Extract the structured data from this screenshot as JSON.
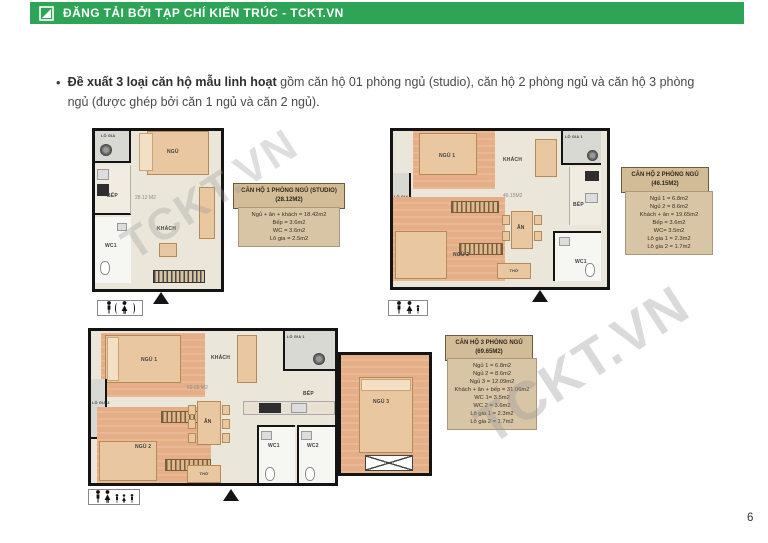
{
  "header": {
    "title": "ĐĂNG TẢI BỞI TẠP CHÍ KIẾN TRÚC - TCKT.VN",
    "logo_icon": "tckt-logo-icon",
    "bg_color": "#2EA457"
  },
  "intro": {
    "bullet": "•",
    "lead": "Đề xuất 3 loại căn hộ mẫu linh hoạt",
    "rest": " gồm căn hộ 01 phòng ngủ (studio), căn hộ 2 phòng ngủ và căn hộ 3 phòng ngủ (được ghép bởi căn 1 ngủ và căn 2 ngủ)."
  },
  "watermarks": [
    {
      "text": "TCKT.VN"
    },
    {
      "text": "TCKT.VN"
    }
  ],
  "plans": [
    {
      "id": "studio",
      "area_label": "28.12 M2",
      "rooms": {
        "logia": "LÔ GIA",
        "ngu": "NGỦ",
        "bep": "BẾP",
        "khach": "KHÁCH",
        "wc1": "WC1"
      },
      "entrance_icon": "up-triangle",
      "occupancy_icons": [
        "person-icon",
        "paren-person-icon"
      ]
    },
    {
      "id": "2-bedroom",
      "area_label": "46.15M2",
      "rooms": {
        "ngu1": "NGỦ 1",
        "khach": "KHÁCH",
        "logia1": "LÔ GIA 1",
        "logia2": "LÔ GIA 2",
        "ngu2": "NGỦ 2",
        "an": "ĂN",
        "bep": "BẾP",
        "tho": "THỜ",
        "wc1": "WC1"
      },
      "entrance_icon": "up-triangle",
      "occupancy_icons": [
        "person-icon",
        "person-icon",
        "child-icon"
      ]
    },
    {
      "id": "3-bedroom",
      "area_label": "69.65 M2",
      "rooms": {
        "ngu1": "NGỦ 1",
        "khach": "KHÁCH",
        "logia1": "LÔ GIA 1",
        "logia2": "LÔ GIA 2",
        "ngu2": "NGỦ 2",
        "ngu3": "NGỦ 3",
        "an": "ĂN",
        "bep": "BẾP",
        "tho": "THỜ",
        "wc1": "WC1",
        "wc2": "WC2"
      },
      "entrance_icon": "up-triangle",
      "occupancy_icons": [
        "person-icon",
        "person-icon",
        "child-icon",
        "child-icon",
        "child-icon"
      ]
    }
  ],
  "info_boxes": [
    {
      "title": "CĂN HỘ 1 PHÒNG NGỦ (STUDIO)",
      "subtitle": "(28.12M2)",
      "lines": [
        "Ngủ + ăn + khách = 18.42m2",
        "Bếp = 3.6m2",
        "WC = 3.6m2",
        "Lô gia = 2.5m2"
      ]
    },
    {
      "title": "CĂN HỘ 2 PHÒNG NGỦ",
      "subtitle": "(46.15M2)",
      "lines": [
        "Ngủ 1 = 6.8m2",
        "Ngủ 2 = 8.6m2",
        "Khách + ăn = 19.65m2",
        "Bếp = 3.6m2",
        "WC= 3.5m2",
        "Lô gia 1 = 2.3m2",
        "Lô gia 2 = 1.7m2"
      ]
    },
    {
      "title": "CĂN HỘ 3 PHÒNG NGỦ",
      "subtitle": "(69.65M2)",
      "lines": [
        "Ngủ 1 = 6.8m2",
        "Ngủ 2 = 8.6m2",
        "Ngủ 3 = 12.09m2",
        "Khách + ăn + bếp = 31.06m2",
        "WC 1= 3.5m2",
        "WC 2 = 3.6m2",
        "Lô gia 1 = 2.3m2",
        "Lô gia 2 = 1.7m2"
      ]
    }
  ],
  "page": {
    "number": "6"
  }
}
